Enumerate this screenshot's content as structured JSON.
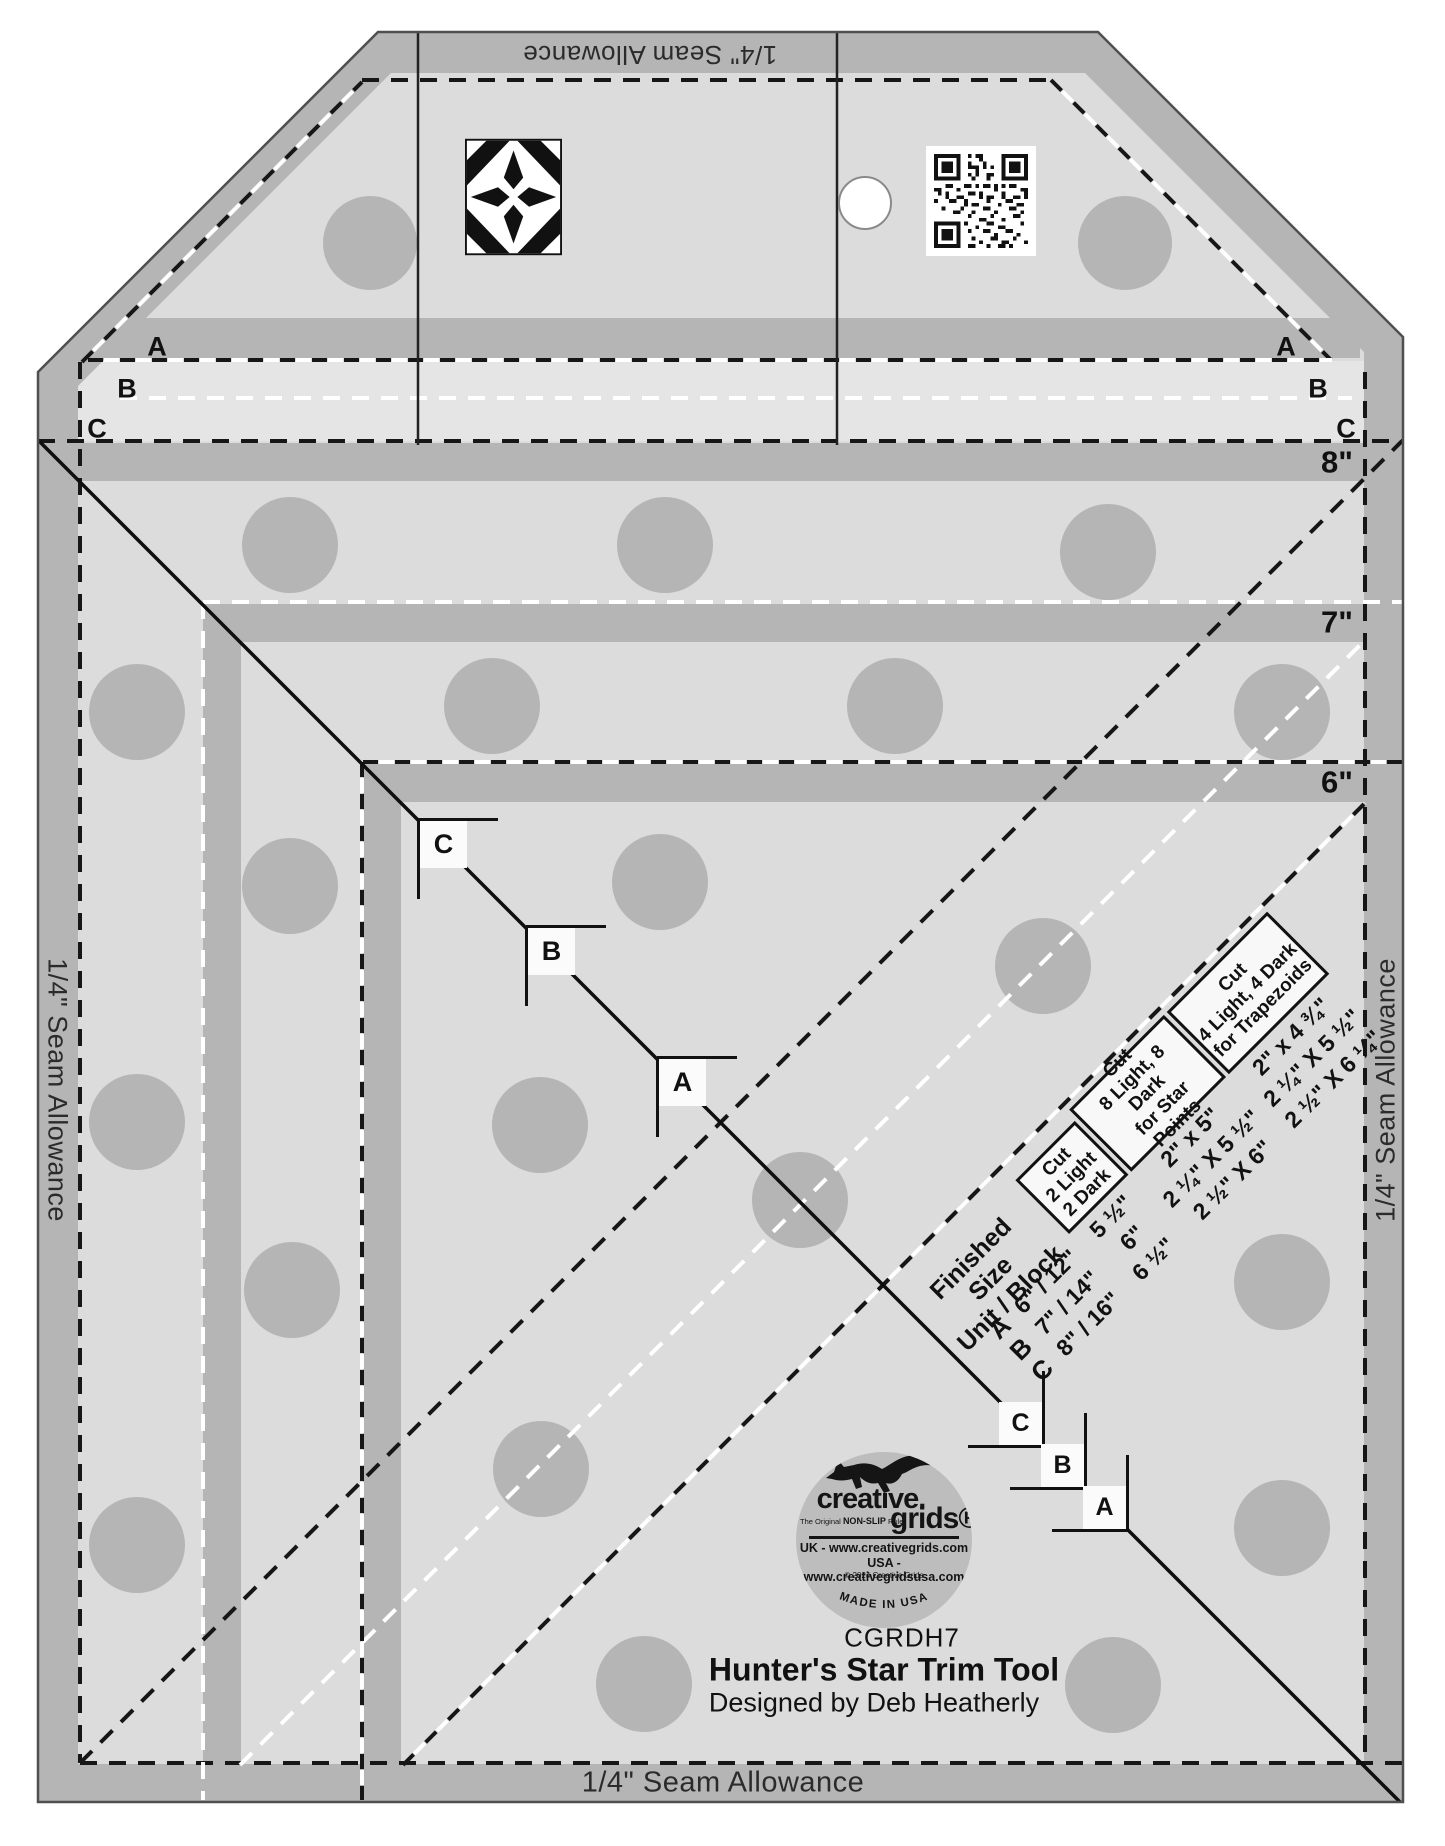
{
  "product": {
    "sku": "CGRDH7",
    "title": "Hunter's Star Trim Tool",
    "designer": "Designed by Deb Heatherly"
  },
  "seam": {
    "top": "1/4\" Seam Allowance",
    "bottom": "1/4\" Seam Allowance",
    "left": "1/4\" Seam Allowance",
    "right": "1/4\" Seam Allowance"
  },
  "marks": {
    "left_letters": [
      "A",
      "B",
      "C"
    ],
    "right_letters": [
      "A",
      "B",
      "C"
    ],
    "size_labels": [
      "8\"",
      "7\"",
      "6\""
    ],
    "diagonal_upper": [
      "C",
      "B",
      "A"
    ],
    "diagonal_lower": [
      "C",
      "B",
      "A"
    ]
  },
  "table": {
    "corner_header": "Finished Size\nUnit / Block",
    "columns": [
      "Cut\n2 Light\n2 Dark",
      "Cut\n8 Light, 8 Dark\nfor Star Points",
      "Cut\n4 Light, 4 Dark\nfor Trapezoids"
    ],
    "rows": [
      {
        "letter": "A",
        "finished": "6\" / 12\"",
        "cut2": "5 ½\"",
        "cut8": "2\" x 5\"",
        "cut4": "2\" x 4 ¾\""
      },
      {
        "letter": "B",
        "finished": "7\" / 14\"",
        "cut2": "6\"",
        "cut8": "2 ¼\" X 5 ½\"",
        "cut4": "2 ¼\" X 5 ½\""
      },
      {
        "letter": "C",
        "finished": "8\" / 16\"",
        "cut2": "6 ½\"",
        "cut8": "2 ½\" X 6\"",
        "cut4": "2 ½\" X 6 ¼\""
      }
    ]
  },
  "logo": {
    "brand_line1": "creative.",
    "brand_line2": "grids®",
    "tagline_pre": "The Original ",
    "tagline_bold": "NON-SLIP",
    "tagline_post": " Ruler",
    "uk": "UK - www.creativegrids.com",
    "usa": "USA - www.creativegridsusa.com",
    "copyright": "© 2024 Creative Grids",
    "made_in": "MADE IN USA"
  },
  "colors": {
    "body": "#dcdcdc",
    "band": "#b5b5b5",
    "strip": "#e5e5e5",
    "ink": "#111111"
  }
}
